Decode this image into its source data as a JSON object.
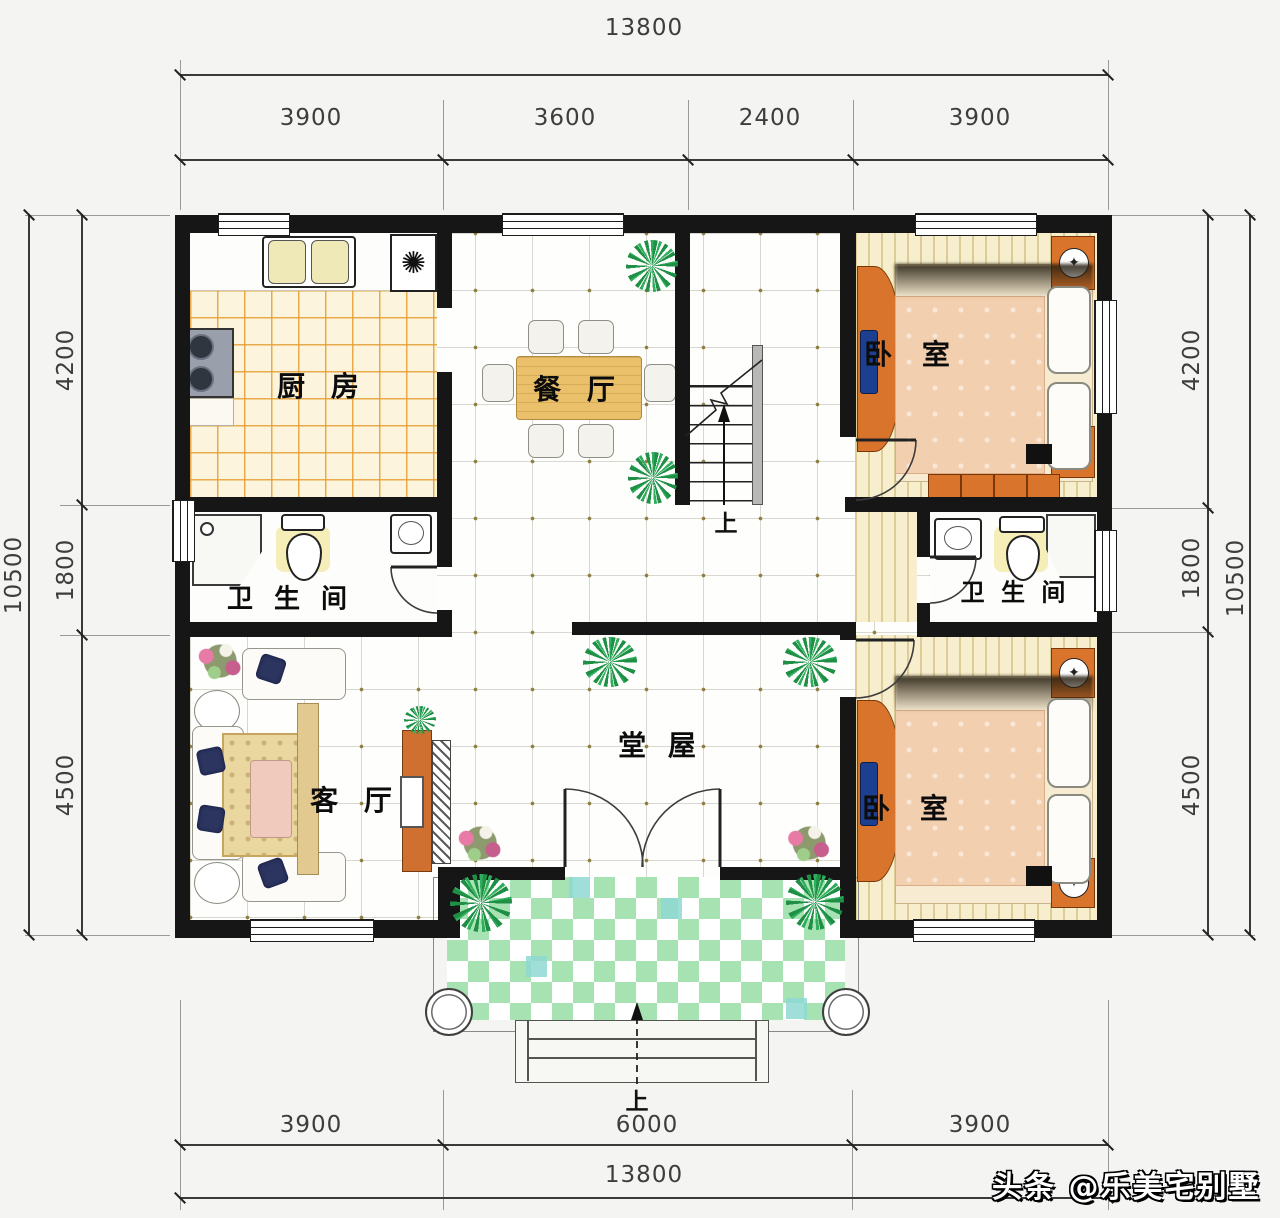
{
  "watermark": {
    "text": "头条 @乐美宅别墅"
  },
  "rooms": {
    "kitchen": "厨 房",
    "dining": "餐 厅",
    "bedroom_top": "卧 室",
    "bedroom_bottom": "卧 室",
    "bathroom_left": "卫 生 间",
    "bathroom_right": "卫 生 间",
    "living": "客 厅",
    "hall": "堂 屋"
  },
  "stairs": {
    "up_label": "上"
  },
  "entry": {
    "up_label": "上"
  },
  "dimensions": {
    "top": {
      "total": "13800",
      "segments": [
        "3900",
        "3600",
        "2400",
        "3900"
      ]
    },
    "bottom": {
      "total": "13800",
      "segments": [
        "3900",
        "6000",
        "3900"
      ]
    },
    "left": {
      "total": "10500",
      "segments": [
        "4200",
        "1800",
        "4500"
      ]
    },
    "right": {
      "total": "10500",
      "segments": [
        "4200",
        "1800",
        "4500"
      ]
    }
  },
  "colors": {
    "wall": "#161616",
    "kitchen_tile_line": "#e49e30",
    "bedroom_floor": "#f6eecd",
    "porch_green": "#a7e3b2",
    "porch_teal": "#8fd8d2",
    "furniture_orange": "#d9742c",
    "blanket_pink": "#f2cfae"
  }
}
